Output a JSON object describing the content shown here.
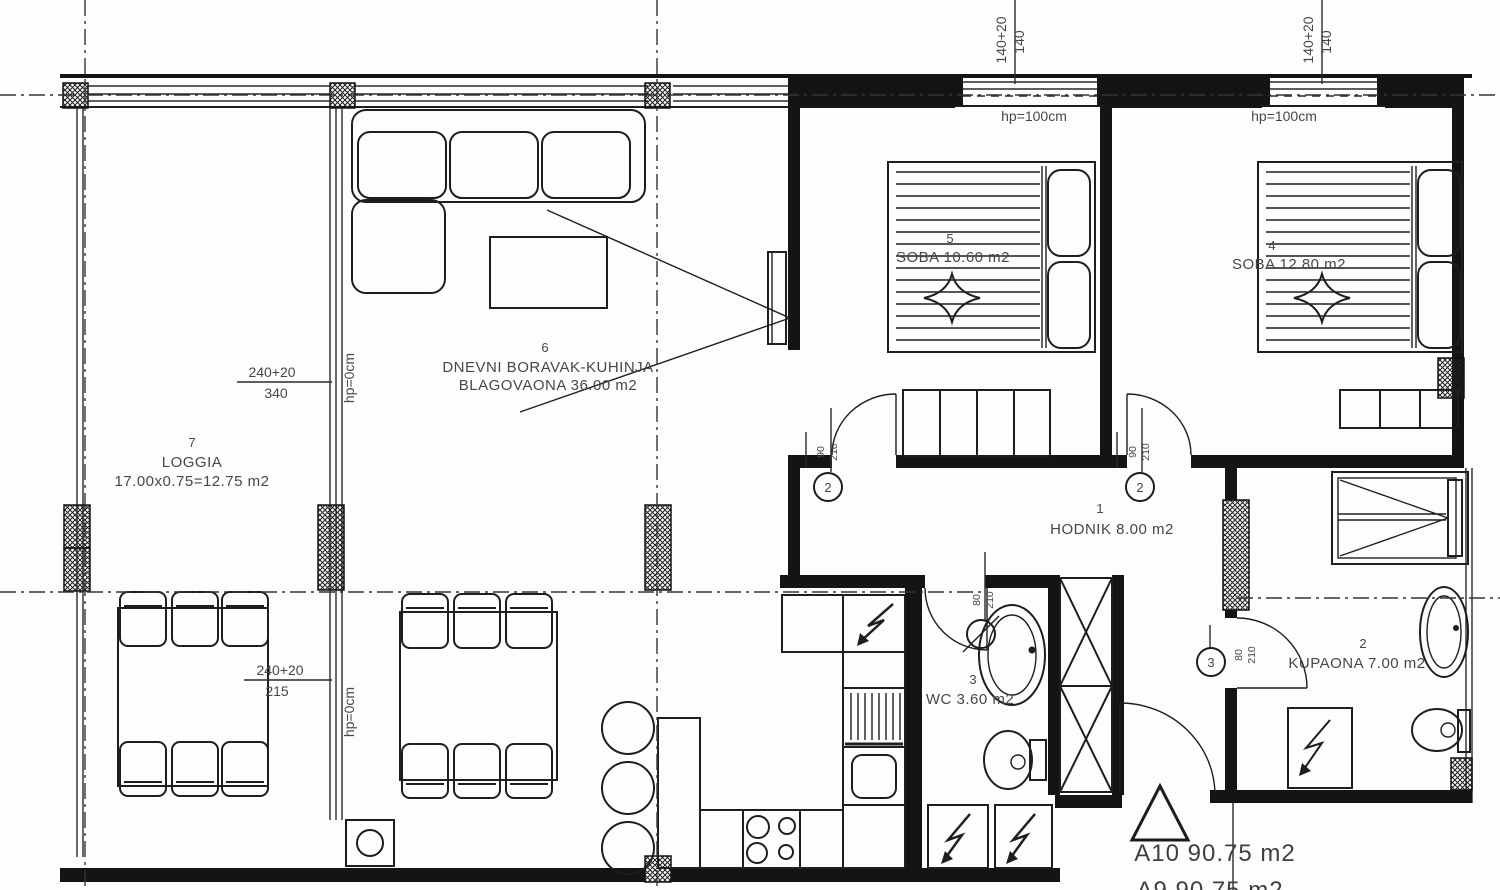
{
  "plan": {
    "area_label": "A10 90.75 m2",
    "area_label_cut": "A9 90.75 m2"
  },
  "rooms": {
    "hodnik": {
      "number": "1",
      "label": "HODNIK 8.00 m2"
    },
    "kupaona": {
      "number": "2",
      "label": "KUPAONA 7.00 m2"
    },
    "wc": {
      "number": "3",
      "label": "WC 3.60 m2"
    },
    "soba_4": {
      "number": "4",
      "label": "SOBA 12.80 m2"
    },
    "soba_5": {
      "number": "5",
      "label": "SOBA 10.60 m2"
    },
    "dnevni": {
      "number": "6",
      "line1": "DNEVNI BORAVAK-KUHINJA",
      "line2": "BLAGOVAONA 36.00 m2"
    },
    "loggia": {
      "number": "7",
      "name": "LOGGIA",
      "dims": "17.00x0.75=12.75 m2"
    }
  },
  "dims": {
    "upper_left_top": "240+20",
    "upper_left_bottom": "340",
    "lower_left_top": "240+20",
    "lower_left_bottom": "215",
    "hp0": "hp=0cm",
    "win_top": "140+20",
    "win_bottom": "140",
    "hp100": "hp=100cm"
  },
  "doors": {
    "d2": {
      "tag": "2",
      "w": "90",
      "h": "210"
    },
    "d3": {
      "tag": "3",
      "w": "80",
      "h": "210"
    },
    "dwc": {
      "w": "80",
      "h": "210"
    }
  }
}
